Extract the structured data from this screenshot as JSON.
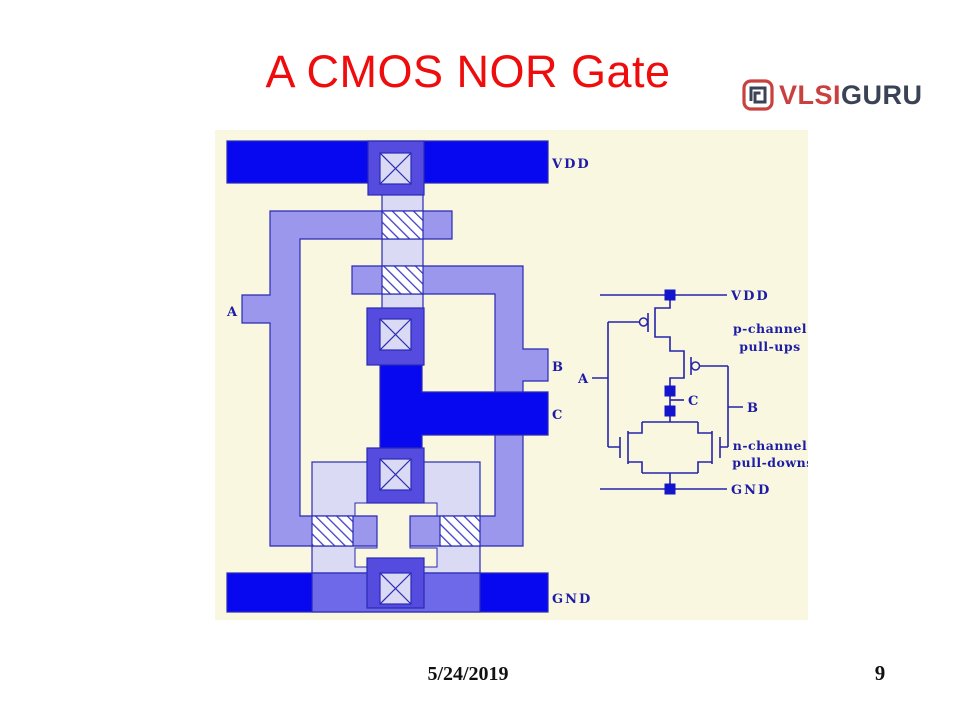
{
  "slide": {
    "title": "A CMOS NOR Gate",
    "footer_date": "5/24/2019",
    "page_number": "9"
  },
  "logo": {
    "brand_primary": "VLSI",
    "brand_secondary": "GURU"
  },
  "layout_diagram": {
    "labels": {
      "vdd": "VDD",
      "a": "A",
      "b": "B",
      "c": "C",
      "gnd": "GND"
    }
  },
  "schematic": {
    "labels": {
      "vdd": "VDD",
      "gnd": "GND",
      "a": "A",
      "b": "B",
      "c": "C"
    },
    "annotations": {
      "p_line1": "p-channel",
      "p_line2": "pull-ups",
      "n_line1": "n-channel",
      "n_line2": "pull-downs"
    }
  },
  "colors": {
    "title_red": "#ee0c0c",
    "logo_red": "#c9413f",
    "logo_dark": "#3a4256",
    "canvas_cream": "#faf7e1",
    "metal_blue": "#0707f0",
    "contact_blue": "#564bdf",
    "rail_overlay_blue": "#6d69e8",
    "poly_periwinkle": "#9a97ed",
    "diffusion_lavender": "#dbdaf4",
    "outline_navy": "#2a2ab4",
    "wire_navy": "#2424ac",
    "label_navy": "#1c1ca4",
    "footer_black": "#111111"
  }
}
